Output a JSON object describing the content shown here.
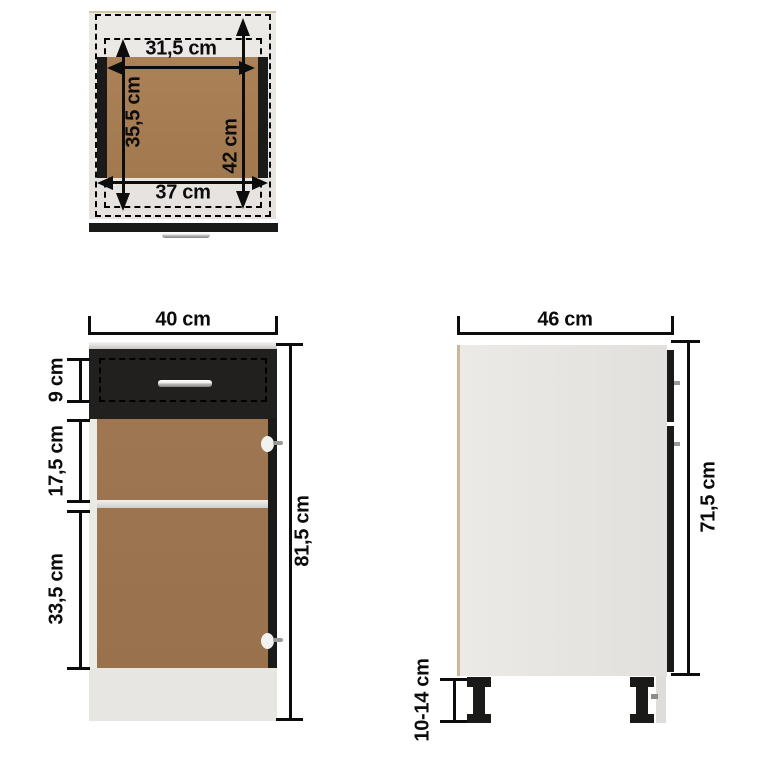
{
  "colors": {
    "background": "#ffffff",
    "panel_gray": "#e9e6e3",
    "wood_top": "#a97f57",
    "wood_front": "#9b7350",
    "part_black": "#1a1a19",
    "dim_black": "#0c0c0c",
    "edge_tan": "#d8c7a7"
  },
  "views": {
    "top": {
      "name": "drawer top view",
      "label_inner_width": "31,5 cm",
      "label_inner_depth": "35,5 cm",
      "label_total_depth": "42 cm",
      "label_bottom_width": "37 cm"
    },
    "front": {
      "name": "cabinet front view",
      "label_width": "40 cm",
      "label_drawer_height": "9 cm",
      "label_top_section": "17,5 cm",
      "label_bottom_section": "33,5 cm",
      "label_total_height": "81,5 cm"
    },
    "side": {
      "name": "cabinet side view",
      "label_depth": "46 cm",
      "label_body_height": "71,5 cm",
      "label_legs_height": "10-14 cm"
    }
  }
}
